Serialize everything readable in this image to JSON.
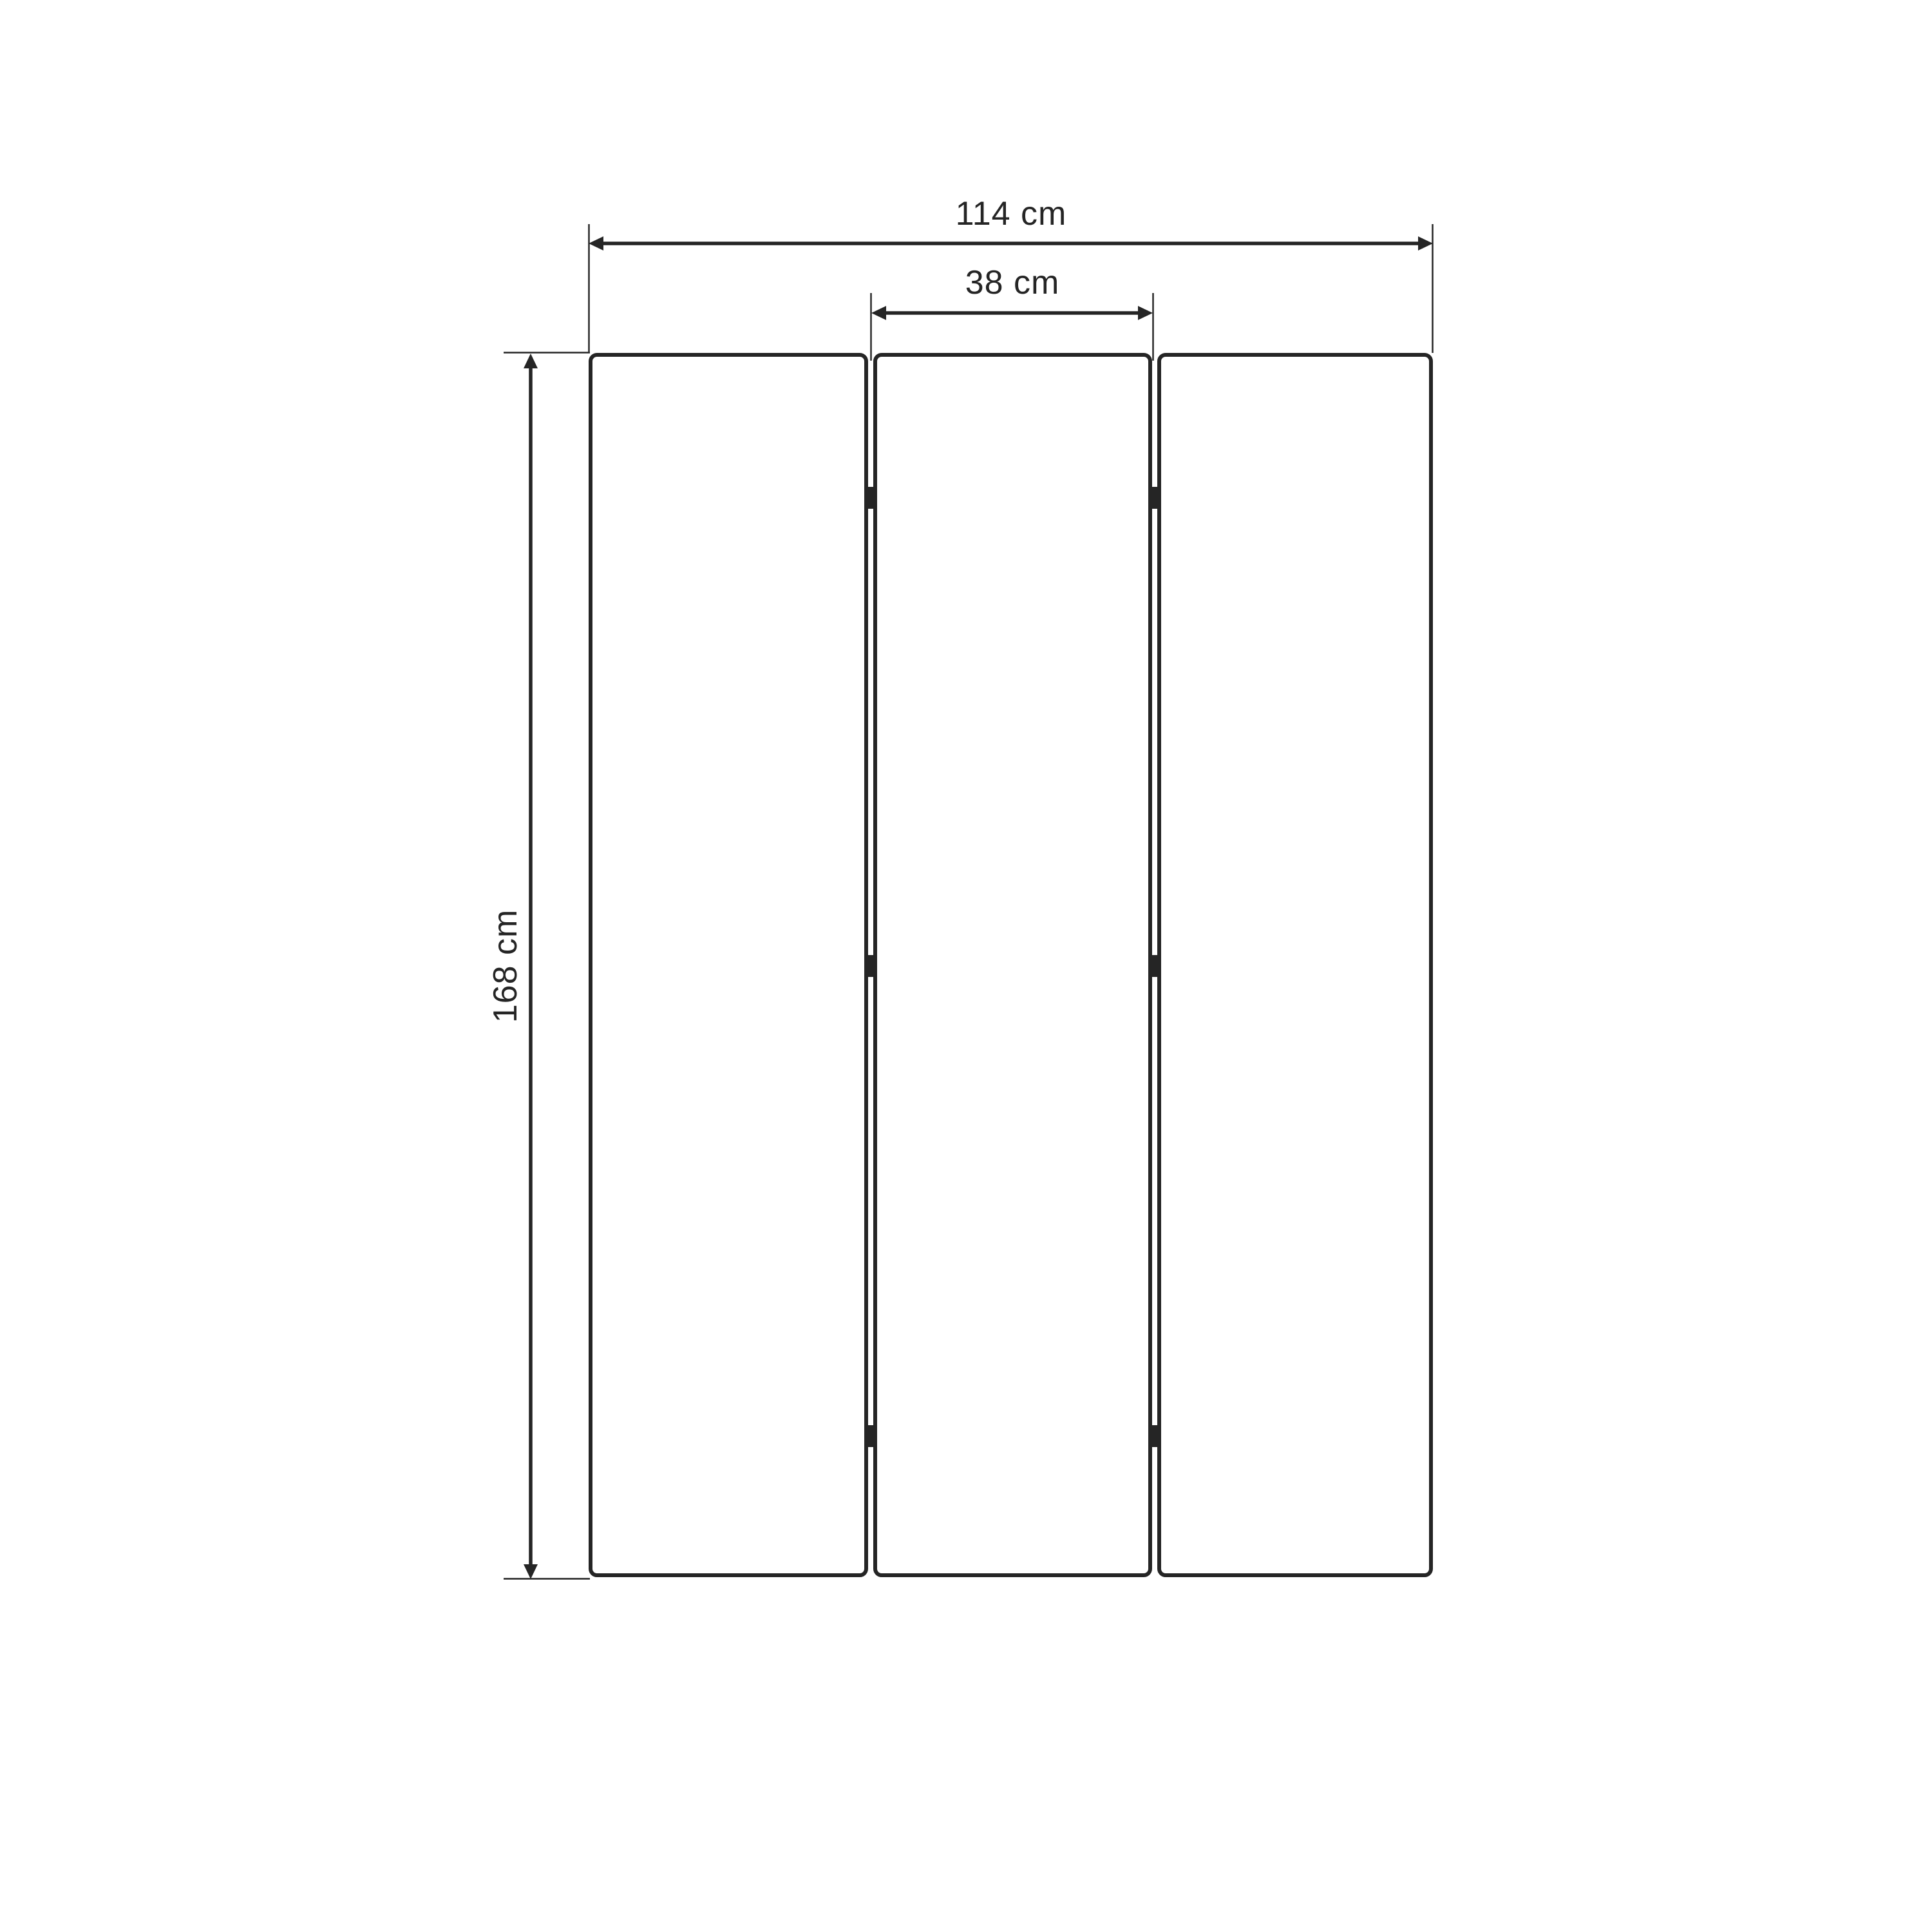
{
  "page": {
    "background_color": "#ffffff"
  },
  "drawing": {
    "type": "technical-dimension-drawing",
    "ink_color": "#252525",
    "panel_fill": "#ffffff",
    "panel_count": 3,
    "dimensions": {
      "total_width": {
        "label": "114 cm"
      },
      "panel_width": {
        "label": "38 cm"
      },
      "panel_height": {
        "label": "168 cm"
      }
    }
  }
}
